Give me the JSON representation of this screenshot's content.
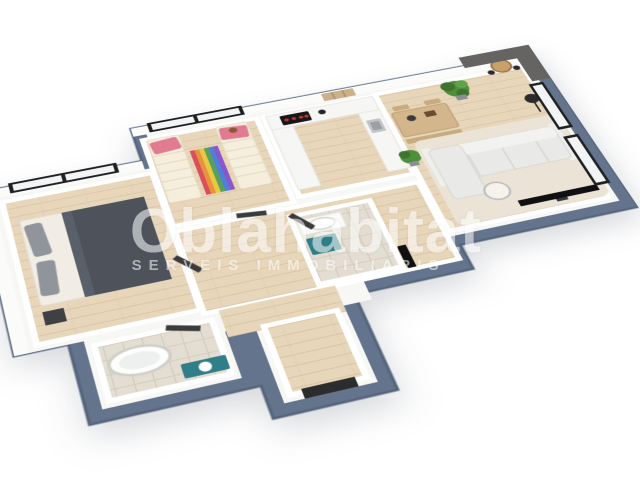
{
  "meta": {
    "type": "isometric-3d-floor-plan-render",
    "description": "3D rendered floor plan of a two-bedroom apartment viewed from above at an angle, on a white background, with a semi-transparent real-estate agency watermark"
  },
  "watermark": {
    "title": "Oblahabitat",
    "subtitle": "SERVEIS IMMOBILIARIS"
  },
  "colors": {
    "outer_wall": "#64748c",
    "outer_wall_dark": "#55657c",
    "inner_wall": "#f7f7f5",
    "wall_light": "#fbfbfa",
    "wood": "#e7d6ba",
    "wood_line": "#d9c19f",
    "tile": "#e3ddd2",
    "tile_line": "#d2cabc",
    "frame_black": "#1f2022",
    "glass": "#f2f4f5",
    "concrete": "#666462",
    "sofa": "#e9e9e7",
    "sofa_back": "#f2f2f0",
    "sofa_line": "#d4d4d1",
    "rug_living": "#eae3d6",
    "bed_sheet": "#f1ede4",
    "bed_blanket": "#4d525b",
    "bed_blanket_fold": "#5a6069",
    "pillow_gray": "#90949b",
    "kid_bed": "#f5eedc",
    "kid_bed_line": "#e4d9bf",
    "pillow_pink": "#e17b92",
    "teddy_brown": "#8a5a33",
    "stripe_1": "#d94f5c",
    "stripe_2": "#e8913f",
    "stripe_3": "#e8c93f",
    "stripe_4": "#58a05c",
    "stripe_5": "#4f7fd9",
    "stripe_6": "#8a56c9",
    "counter": "#f6f6f4",
    "counter_line": "#e1e1dd",
    "hob_black": "#17171a",
    "hob_red": "#c4372f",
    "sink_gray": "#c2c6ca",
    "sink_dark": "#9ba0a5",
    "shelf_wood": "#cbb089",
    "shelf_line": "#a8895f",
    "table_wood": "#d3b68c",
    "table_edge": "#b09066",
    "bench_wood": "#c9ab80",
    "plant_green": "#4e8f3c",
    "plant_dark": "#3f7330",
    "plant_light": "#5fa24a",
    "pot_gray": "#8b8f94",
    "tv_black": "#101012",
    "door_dark": "#3b3b3d",
    "front_door": "#2c2c2e",
    "teal": "#2f7e88",
    "tub_white": "#fdfdfb",
    "tub_rim": "#cfcfc9",
    "tub_inner": "#eef0ef",
    "lamp_black": "#2b2b2e",
    "bar_table": "#c9a06a",
    "bar_table_edge": "#93703f"
  },
  "floor_plan": {
    "view": "top-down isometric",
    "rooms": [
      {
        "name": "master bedroom",
        "contents": [
          "double bed with dark grey duvet",
          "grey pillows",
          "nightstand",
          "black framed sliding glass door"
        ]
      },
      {
        "name": "kids bedroom",
        "contents": [
          "two single beds",
          "pink pillows",
          "striped colourful rug",
          "teddy bear",
          "black framed window"
        ]
      },
      {
        "name": "kitchen",
        "contents": [
          "U-shaped white counter",
          "black hob with red knobs",
          "sink",
          "wooden cube wall shelf"
        ]
      },
      {
        "name": "dining area",
        "contents": [
          "wooden table",
          "bench",
          "potted plants"
        ]
      },
      {
        "name": "living room",
        "contents": [
          "white sofa",
          "flat screen TV",
          "round coffee table",
          "floor lamp",
          "bar table with stools",
          "concrete accent wall",
          "floor-to-ceiling windows",
          "beige rug"
        ]
      },
      {
        "name": "bathroom 1",
        "contents": [
          "freestanding bathtub",
          "teal vanity unit"
        ]
      },
      {
        "name": "bathroom 2",
        "contents": [
          "washbasin",
          "teal cabinet"
        ]
      },
      {
        "name": "hallway",
        "contents": [
          "open dark doors",
          "black wall panel"
        ]
      },
      {
        "name": "entrance",
        "contents": [
          "dark front door"
        ]
      }
    ]
  }
}
